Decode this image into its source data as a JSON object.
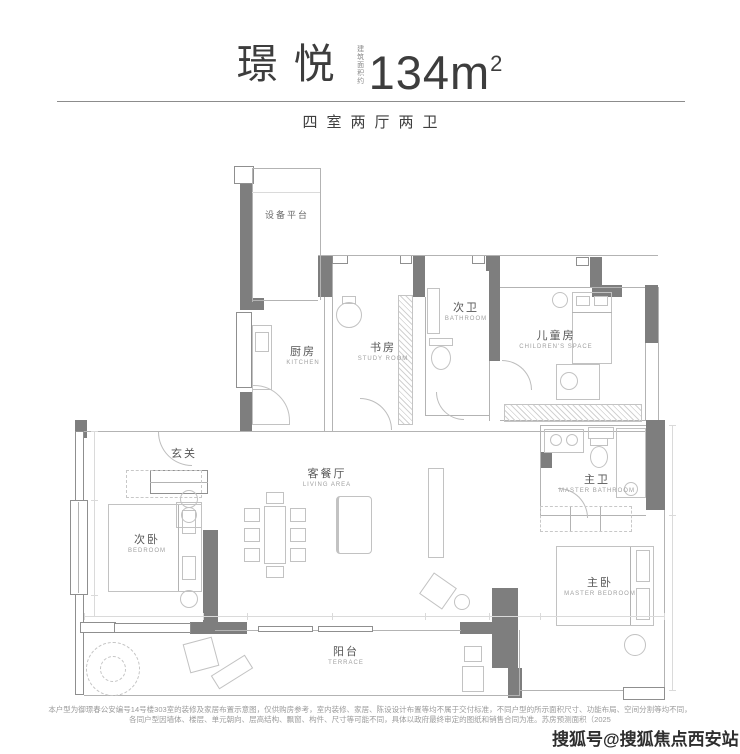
{
  "header": {
    "title": "璟悦",
    "area_note": "建筑面积约",
    "area_value": "134m",
    "area_sup": "2",
    "subtitle": "四室两厅两卫"
  },
  "rooms": {
    "equipment": {
      "cn": "设备平台",
      "en": ""
    },
    "kitchen": {
      "cn": "厨房",
      "en": "KITCHEN"
    },
    "study": {
      "cn": "书房",
      "en": "STUDY ROOM"
    },
    "bath2": {
      "cn": "次卫",
      "en": "BATHROOM"
    },
    "children": {
      "cn": "儿童房",
      "en": "CHILDREN'S SPACE"
    },
    "hallway": {
      "cn": "玄关",
      "en": ""
    },
    "living": {
      "cn": "客餐厅",
      "en": "LIVING AREA"
    },
    "bedroom2": {
      "cn": "次卧",
      "en": "BEDROOM"
    },
    "master_bath": {
      "cn": "主卫",
      "en": "MASTER BATHROOM"
    },
    "master_bedroom": {
      "cn": "主卧",
      "en": "MASTER BEDROOM"
    },
    "terrace": {
      "cn": "阳台",
      "en": "TERRACE"
    }
  },
  "footer": {
    "line1": "本户型为御璟春公安编号14号楼303室的装修及家居布置示意图，仅供购房参考，室内装修、家居、陈设设计布置等均不属于交付标准，不同户型的所示面积尺寸、功能布局、空间分割等均不同，",
    "line2": "各同户型因墙体、楼层、单元朝向、层高结构、飘窗、构件、尺寸等可能不同，具体以政府最终审定的图纸和销售合同为准。苏房预测面积（2025"
  },
  "watermark": {
    "text": "搜狐号@搜狐焦点西安站"
  },
  "colors": {
    "wall": "#7e7e7e",
    "line": "#b3b3b3",
    "title_text": "#3d3d3d",
    "watermark_text": "#2e2e2e"
  }
}
